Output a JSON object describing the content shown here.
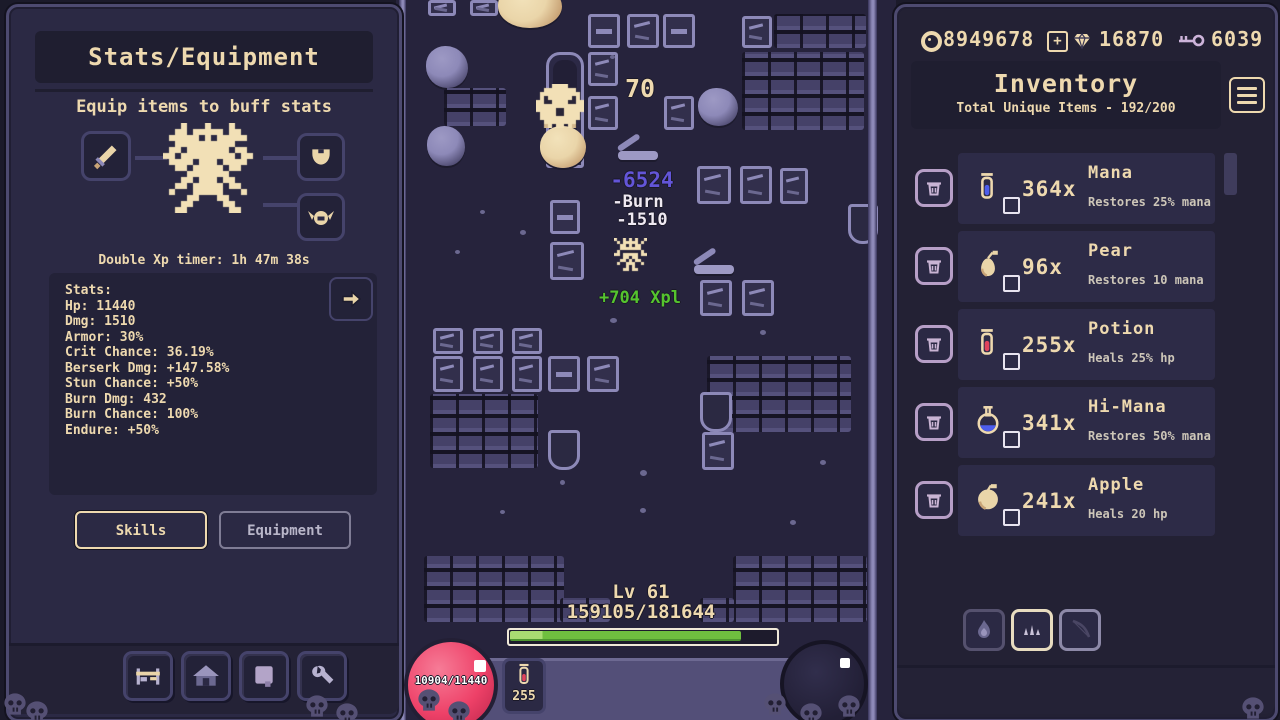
{
  "left_panel": {
    "title": "Stats/Equipment",
    "subtitle": "Equip items to buff stats",
    "xp_timer": "Double Xp timer: 1h 47m 38s",
    "stats_lines": [
      "Stats:",
      "Hp: 11440",
      "Dmg: 1510",
      "Armor: 30%",
      "Crit Chance: 36.19%",
      "Berserk Dmg: +147.58%",
      "Stun Chance: +50%",
      "Burn Dmg: 432",
      "Burn Chance: 100%",
      "Endure: +50%"
    ],
    "skills_label": "Skills",
    "equipment_label": "Equipment"
  },
  "game": {
    "enemy_hp": "70",
    "crit_damage": "-6524",
    "burn_label": "-Burn",
    "burn_damage": "-1510",
    "xp_gain": "+704 Xpl",
    "level_label": "Lv 61",
    "xp_progress": "159105/181644",
    "xp_percent": 87.6,
    "hp_orb_value": "10904/11440",
    "potion_count": "255"
  },
  "top_bar": {
    "coins": "8949678",
    "gems": "16870",
    "keys": "6039",
    "plus_label": "+"
  },
  "inventory": {
    "title": "Inventory",
    "subtitle": "Total Unique Items - 192/200",
    "items": [
      {
        "icon": "mana-vial",
        "count": "364x",
        "name": "Mana",
        "desc": "Restores 25% mana"
      },
      {
        "icon": "pear",
        "count": "96x",
        "name": "Pear",
        "desc": "Restores 10 mana"
      },
      {
        "icon": "potion",
        "count": "255x",
        "name": "Potion",
        "desc": "Heals 25% hp"
      },
      {
        "icon": "hi-mana-flask",
        "count": "341x",
        "name": "Hi-Mana",
        "desc": "Restores 50% mana"
      },
      {
        "icon": "apple",
        "count": "241x",
        "name": "Apple",
        "desc": "Heals 20 hp"
      }
    ]
  },
  "colors": {
    "cream": "#eed9af",
    "panel_bg": "#2b2944",
    "xp_bar_green": "#6fbf3f",
    "hp_pink": "#ee4168",
    "crit_purple": "#6355d8",
    "xp_text_green": "#55c42e"
  }
}
